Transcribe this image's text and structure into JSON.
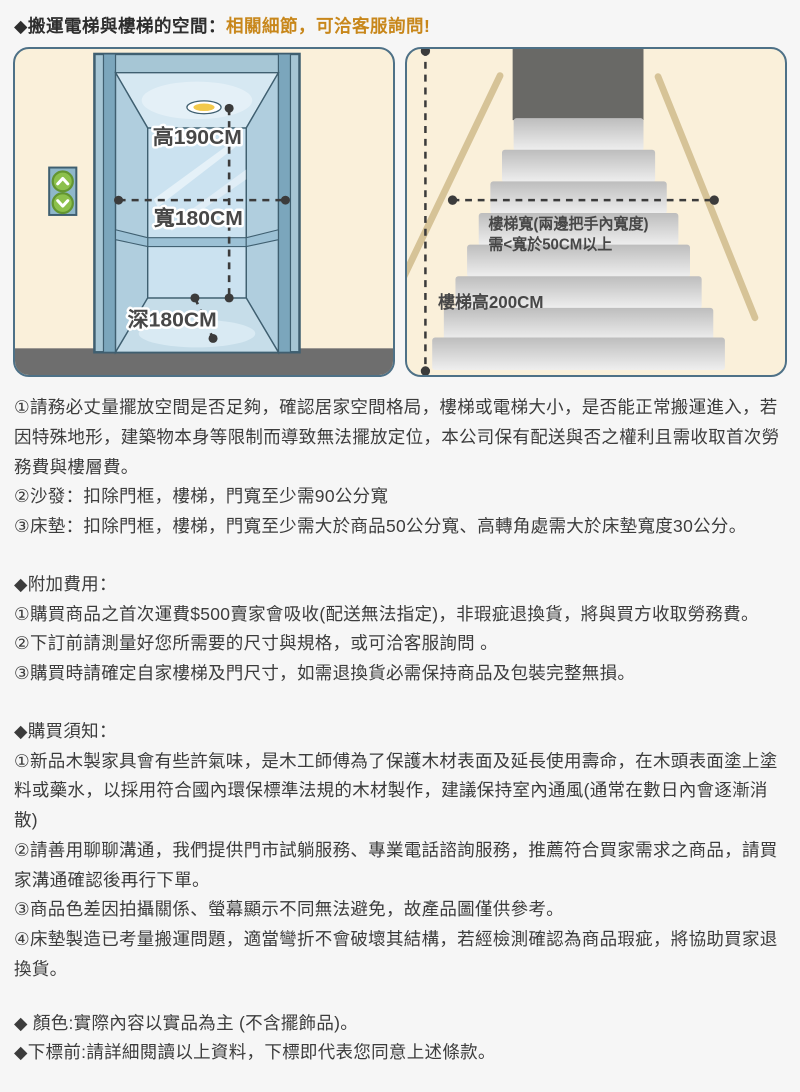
{
  "title": {
    "prefix": "◆搬運電梯與樓梯的空間：",
    "highlight": "相關細節，可洽客服詢問!"
  },
  "colors": {
    "accent_orange": "#c8871b",
    "card_border": "#4e7187",
    "card_bg": "#faf0da",
    "elevator_blue": "#7ba6bc",
    "button_green": "#8cc04c",
    "handrail_tan": "#d6c397",
    "floor_gray": "#6e6e6e"
  },
  "elevator": {
    "height_label": "高190CM",
    "width_label": "寬180CM",
    "depth_label": "深180CM"
  },
  "stairs": {
    "width_label_line1": "樓梯寬(兩邊把手內寬度)",
    "width_label_line2": "需<寬於50CM以上",
    "height_label": "樓梯高200CM"
  },
  "notes": {
    "measure": {
      "items": [
        "①請務必丈量擺放空間是否足夠，確認居家空間格局，樓梯或電梯大小，是否能正常搬運進入，若因特殊地形，建築物本身等限制而導致無法擺放定位，本公司保有配送與否之權利且需收取首次勞務費與樓層費。",
        "②沙發：扣除門框，樓梯，門寬至少需90公分寬",
        "③床墊：扣除門框，樓梯，門寬至少需大於商品50公分寬、高轉角處需大於床墊寬度30公分。"
      ]
    },
    "fees": {
      "heading": "◆附加費用：",
      "items": [
        "①購買商品之首次運費$500賣家會吸收(配送無法指定)，非瑕疵退換貨，將與買方收取勞務費。",
        "②下訂前請測量好您所需要的尺寸與規格，或可洽客服詢問 。",
        "③購買時請確定自家樓梯及門尺寸，如需退換貨必需保持商品及包裝完整無損。"
      ]
    },
    "purchase": {
      "heading": "◆購買須知：",
      "items": [
        "①新品木製家具會有些許氣味，是木工師傅為了保護木材表面及延長使用壽命，在木頭表面塗上塗料或藥水，以採用符合國內環保標準法規的木材製作，建議保持室內通風(通常在數日內會逐漸消散)",
        "②請善用聊聊溝通，我們提供門市試躺服務、專業電話諮詢服務，推薦符合買家需求之商品，請買家溝通確認後再行下單。",
        "③商品色差因拍攝關係、螢幕顯示不同無法避免，故產品圖僅供參考。",
        "④床墊製造已考量搬運問題，適當彎折不會破壞其結構，若經檢測確認為商品瑕疵，將協助買家退換貨。"
      ]
    },
    "footer": {
      "items": [
        "◆ 顏色:實際內容以實品為主 (不含擺飾品)。",
        "◆下標前:請詳細閱讀以上資料，下標即代表您同意上述條款。"
      ]
    }
  }
}
